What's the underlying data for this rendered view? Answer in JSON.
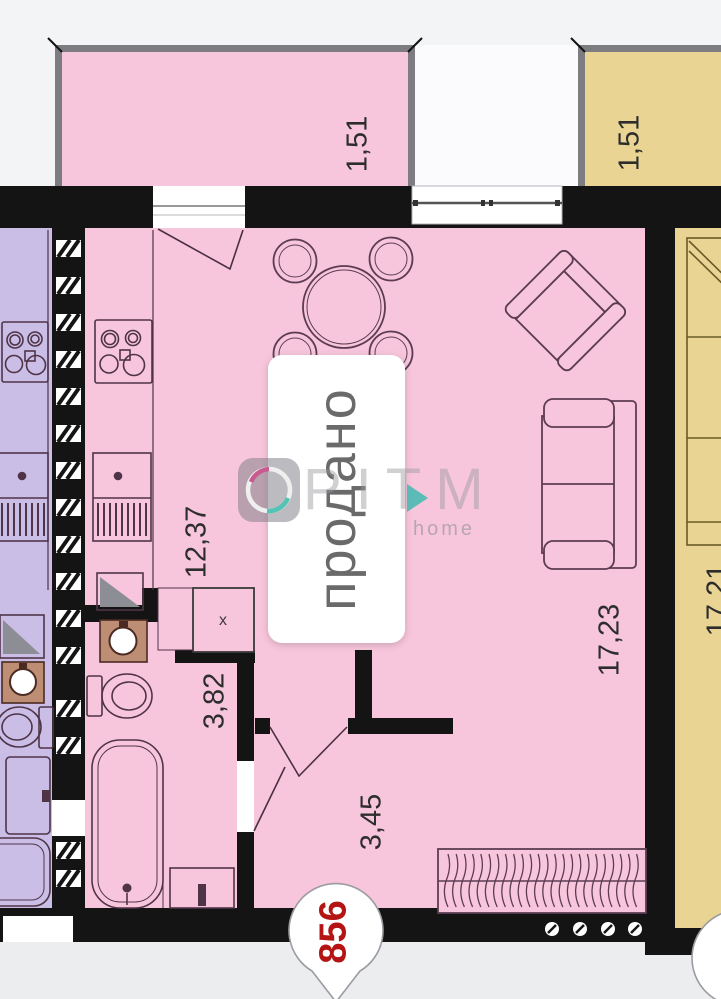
{
  "plan": {
    "status_sticker": "продано",
    "unit_marker": "856",
    "vent_mark": "x",
    "watermark": {
      "brand": "РІТМ",
      "tagline": "home"
    },
    "dimensions": {
      "balcony_left": "1,51",
      "balcony_right": "1,51",
      "kitchen_living": "12,37",
      "living_room": "17,23",
      "bathroom": "3,82",
      "hallway": "3,45",
      "adjacent_room": "17,21"
    },
    "colors": {
      "apartment_fill": "#f8c6dc",
      "neighbor_left_fill": "#cabde6",
      "neighbor_right_fill": "#e9d493",
      "wall": "#141414",
      "balcony_wall": "#7c7c81",
      "furniture_line": "#5c3c52",
      "unit_number_color": "#b51414",
      "washbasin_fill": "#bd8e74",
      "shower_triangle": "#8d8d95"
    }
  }
}
